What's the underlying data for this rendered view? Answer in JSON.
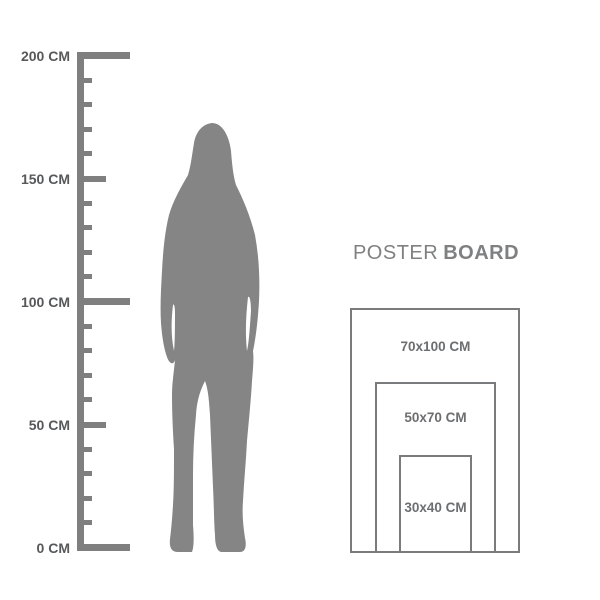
{
  "page": {
    "background_color": "#ffffff",
    "description_labels": {
      "ruler_unit": "CM"
    }
  },
  "ruler": {
    "color": "#7f7f7f",
    "label_color": "#57585a",
    "labels": [
      {
        "cm": 200,
        "text": "200 CM"
      },
      {
        "cm": 150,
        "text": "150 CM"
      },
      {
        "cm": 100,
        "text": "100 CM"
      },
      {
        "cm": 50,
        "text": "50 CM"
      },
      {
        "cm": 0,
        "text": "0 CM"
      }
    ],
    "ticks": [
      {
        "cm": 200,
        "size": "long"
      },
      {
        "cm": 190,
        "size": "short"
      },
      {
        "cm": 180,
        "size": "short"
      },
      {
        "cm": 170,
        "size": "short"
      },
      {
        "cm": 160,
        "size": "short"
      },
      {
        "cm": 150,
        "size": "medium"
      },
      {
        "cm": 140,
        "size": "short"
      },
      {
        "cm": 130,
        "size": "short"
      },
      {
        "cm": 120,
        "size": "short"
      },
      {
        "cm": 110,
        "size": "short"
      },
      {
        "cm": 100,
        "size": "long"
      },
      {
        "cm": 90,
        "size": "short"
      },
      {
        "cm": 80,
        "size": "short"
      },
      {
        "cm": 70,
        "size": "short"
      },
      {
        "cm": 60,
        "size": "short"
      },
      {
        "cm": 50,
        "size": "medium"
      },
      {
        "cm": 40,
        "size": "short"
      },
      {
        "cm": 30,
        "size": "short"
      },
      {
        "cm": 20,
        "size": "short"
      },
      {
        "cm": 10,
        "size": "short"
      },
      {
        "cm": 0,
        "size": "long"
      }
    ]
  },
  "figure": {
    "label": "female-silhouette",
    "color": "#858585"
  },
  "poster_board": {
    "title_regular": "POSTER",
    "title_bold": "BOARD",
    "title_color": "#7f8082",
    "border_color": "#7a7b7d",
    "label_color": "#6d6e70",
    "sizes": [
      {
        "label": "70x100 CM",
        "width_cm": 70,
        "height_cm": 100
      },
      {
        "label": "50x70 CM",
        "width_cm": 50,
        "height_cm": 70
      },
      {
        "label": "30x40 CM",
        "width_cm": 30,
        "height_cm": 40
      }
    ]
  }
}
